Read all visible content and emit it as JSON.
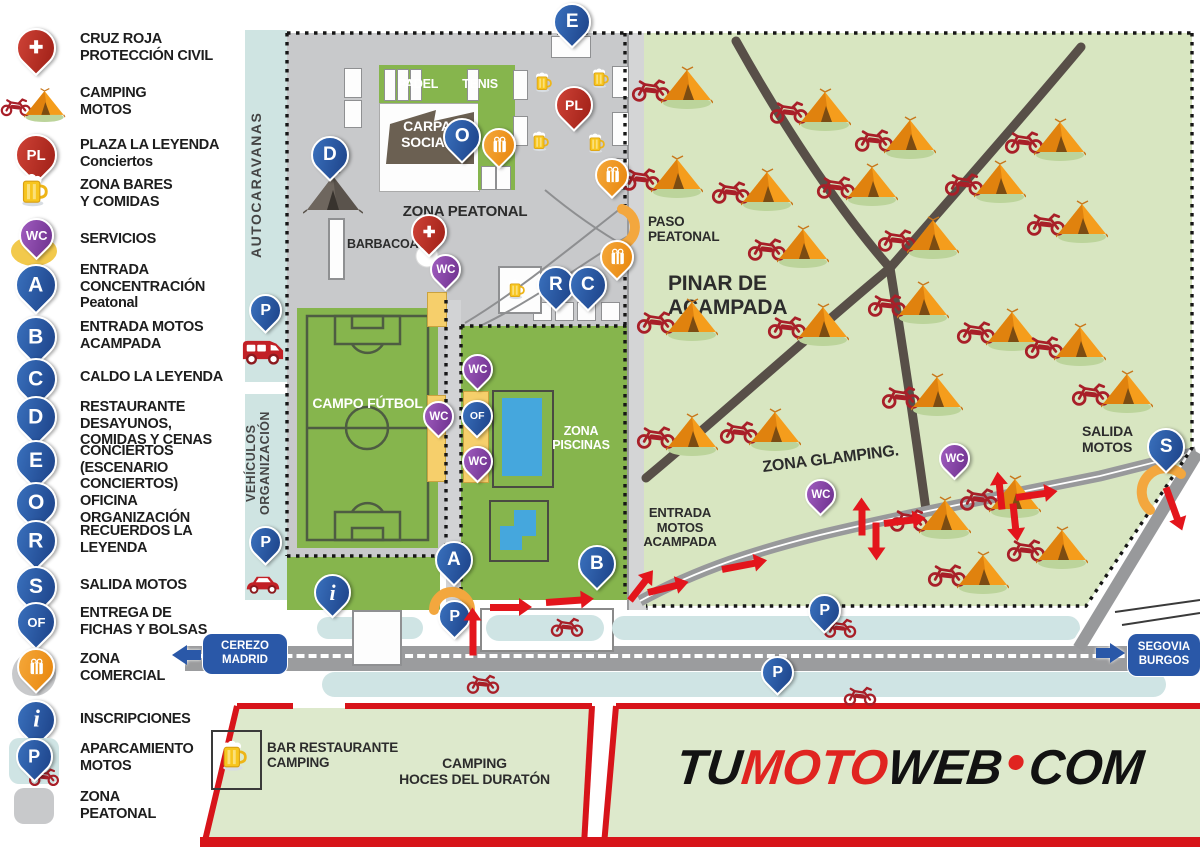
{
  "title": "Mapa concentración motera - plano del recinto",
  "colors": {
    "blue_pin": "#24549c",
    "red_pin": "#b92c21",
    "purple_pin": "#7c3f98",
    "orange": "#f29b1d",
    "camp_green": "#d8e6c1",
    "sport_green": "#86b54d",
    "gray_zone": "#c8c9cb",
    "road_gray": "#9b9c9e",
    "light_blue": "#cfe4e4",
    "service_yellow": "#f6cf6b",
    "red_accent": "#d7141a",
    "logo_red": "#e02420",
    "path_brown": "#584f48",
    "pool_blue": "#45a7dd"
  },
  "legend": {
    "items": [
      {
        "k": "cross",
        "label": "CRUZ ROJA\nPROTECCIÓN CIVIL",
        "y": 26,
        "name": "legend-cruz-roja"
      },
      {
        "k": "camp",
        "label": "CAMPING\nMOTOS",
        "y": 80,
        "name": "legend-camping-motos"
      },
      {
        "k": "pl",
        "t": "PL",
        "label": "PLAZA LA LEYENDA\nConciertos",
        "y": 132,
        "name": "legend-plaza-la-leyenda"
      },
      {
        "k": "mug",
        "label": "ZONA BARES\nY COMIDAS",
        "y": 172,
        "name": "legend-zona-bares"
      },
      {
        "k": "wcy",
        "t": "WC",
        "label": "SERVICIOS",
        "y": 218,
        "name": "legend-servicios"
      },
      {
        "k": "b",
        "t": "A",
        "label": "ENTRADA\nCONCENTRACIÓN\nPeatonal",
        "y": 262,
        "name": "legend-entrada-concentracion"
      },
      {
        "k": "b",
        "t": "B",
        "label": "ENTRADA MOTOS\nACAMPADA",
        "y": 314,
        "name": "legend-entrada-motos-acampada"
      },
      {
        "k": "b",
        "t": "C",
        "label": "CALDO LA LEYENDA",
        "y": 356,
        "name": "legend-caldo-la-leyenda"
      },
      {
        "k": "b",
        "t": "D",
        "label": "RESTAURANTE DESAYUNOS,\nCOMIDAS Y CENAS",
        "y": 394,
        "name": "legend-restaurante"
      },
      {
        "k": "b",
        "t": "E",
        "label": "CONCIERTOS\n(ESCENARIO CONCIERTOS)",
        "y": 438,
        "name": "legend-conciertos"
      },
      {
        "k": "b",
        "t": "O",
        "label": "OFICINA ORGANIZACIÓN",
        "y": 480,
        "name": "legend-oficina-organizacion"
      },
      {
        "k": "b",
        "t": "R",
        "label": "RECUERDOS LA\nLEYENDA",
        "y": 518,
        "name": "legend-recuerdos"
      },
      {
        "k": "b",
        "t": "S",
        "label": "SALIDA MOTOS",
        "y": 564,
        "name": "legend-salida-motos"
      },
      {
        "k": "of",
        "t": "OF",
        "label": "ENTREGA DE\nFICHAS Y BOLSAS",
        "y": 600,
        "name": "legend-entrega-fichas"
      },
      {
        "k": "bagc",
        "label": "ZONA\nCOMERCIAL",
        "y": 646,
        "name": "legend-zona-comercial"
      },
      {
        "k": "info",
        "t": "i",
        "label": "INSCRIPCIONES",
        "y": 698,
        "name": "legend-inscripciones"
      },
      {
        "k": "pmoto",
        "t": "P",
        "label": "APARCAMIENTO\nMOTOS",
        "y": 736,
        "name": "legend-aparcamiento-motos"
      },
      {
        "k": "gray",
        "label": "ZONA\nPEATONAL",
        "y": 784,
        "name": "legend-zona-peatonal"
      }
    ]
  },
  "map": {
    "labels": {
      "padel": "PADEL",
      "tenis": "TENIS",
      "carpa": "CARPA\nSOCIAL",
      "zonaPeatonal": "ZONA PEATONAL",
      "barbacoas": "BARBACOAS",
      "campo": "CAMPO FÚTBOL",
      "piscinas": "ZONA\nPISCINAS",
      "paso": "PASO\nPEATONAL",
      "pinar": "PINAR DE\nACAMPADA",
      "glamping": "ZONA GLAMPING.",
      "entrada": "ENTRADA\nMOTOS\nACAMPADA",
      "salida": "SALIDA\nMOTOS",
      "autocaravanas": "AUTOCARAVANAS",
      "vehiculos": "VEHÍCULOS\nORGANIZACIÓN",
      "barRest": "BAR RESTAURANTE\nCAMPING",
      "hoces": "CAMPING\nHOCES DEL DURATÓN"
    },
    "signs": {
      "west": "CEREZO\nMADRID",
      "east": "SEGOVIA\nBURGOS"
    },
    "logo": {
      "tu": "TU",
      "moto": "MOTO",
      "web": "WEB",
      "com": "COM"
    },
    "pins": [
      {
        "k": "b",
        "t": "E",
        "x": 570,
        "y": 3,
        "n": "map-pin-e-conciertos"
      },
      {
        "k": "b",
        "t": "O",
        "x": 460,
        "y": 118,
        "n": "map-pin-o-oficina"
      },
      {
        "k": "r",
        "t": "PL",
        "x": 572,
        "y": 86,
        "n": "map-pin-pl-plaza"
      },
      {
        "k": "b",
        "t": "D",
        "x": 328,
        "y": 136,
        "n": "map-pin-d-restaurante"
      },
      {
        "k": "b",
        "t": "R",
        "x": 554,
        "y": 266,
        "n": "map-pin-r-recuerdos"
      },
      {
        "k": "b",
        "t": "C",
        "x": 586,
        "y": 266,
        "n": "map-pin-c-caldo"
      },
      {
        "k": "b",
        "t": "A",
        "x": 452,
        "y": 541,
        "n": "map-pin-a-entrada"
      },
      {
        "k": "b",
        "t": "B",
        "x": 595,
        "y": 545,
        "n": "map-pin-b-entrada-motos"
      },
      {
        "k": "b",
        "t": "S",
        "x": 1164,
        "y": 428,
        "n": "map-pin-s-salida"
      },
      {
        "k": "info",
        "t": "i",
        "x": 330,
        "y": 574,
        "n": "map-pin-inscripciones"
      },
      {
        "k": "cross",
        "x": 427,
        "y": 214,
        "n": "map-pin-cruz-roja"
      },
      {
        "k": "p",
        "t": "P",
        "x": 263,
        "y": 294,
        "n": "map-pin-parking-autocaravanas"
      },
      {
        "k": "p",
        "t": "P",
        "x": 263,
        "y": 526,
        "n": "map-pin-parking-vehiculos"
      },
      {
        "k": "p",
        "t": "P",
        "x": 452,
        "y": 600,
        "n": "map-pin-parking-entrada"
      },
      {
        "k": "p",
        "t": "P",
        "x": 822,
        "y": 594,
        "n": "map-pin-parking-road-1"
      },
      {
        "k": "p",
        "t": "P",
        "x": 775,
        "y": 656,
        "n": "map-pin-parking-road-2"
      },
      {
        "k": "w",
        "t": "WC",
        "x": 443,
        "y": 254,
        "n": "map-pin-wc-1"
      },
      {
        "k": "w",
        "t": "WC",
        "x": 436,
        "y": 401,
        "n": "map-pin-wc-2"
      },
      {
        "k": "w",
        "t": "WC",
        "x": 475,
        "y": 354,
        "n": "map-pin-wc-3"
      },
      {
        "k": "of",
        "t": "OF",
        "x": 475,
        "y": 400,
        "n": "map-pin-of-fichas"
      },
      {
        "k": "w",
        "t": "WC",
        "x": 475,
        "y": 446,
        "n": "map-pin-wc-4"
      },
      {
        "k": "w",
        "t": "WC",
        "x": 818,
        "y": 479,
        "n": "map-pin-wc-5"
      },
      {
        "k": "w",
        "t": "WC",
        "x": 952,
        "y": 443,
        "n": "map-pin-wc-6"
      },
      {
        "k": "bag",
        "x": 497,
        "y": 128,
        "n": "map-pin-comercial-1"
      },
      {
        "k": "bag",
        "x": 610,
        "y": 158,
        "n": "map-pin-comercial-2"
      },
      {
        "k": "bag",
        "x": 615,
        "y": 240,
        "n": "map-pin-comercial-3"
      }
    ],
    "tents": [
      [
        687,
        88
      ],
      [
        825,
        110
      ],
      [
        910,
        138
      ],
      [
        1060,
        140
      ],
      [
        677,
        177
      ],
      [
        767,
        190
      ],
      [
        872,
        185
      ],
      [
        1000,
        182
      ],
      [
        1082,
        222
      ],
      [
        933,
        238
      ],
      [
        803,
        247
      ],
      [
        692,
        320
      ],
      [
        823,
        325
      ],
      [
        923,
        303
      ],
      [
        1012,
        330
      ],
      [
        1080,
        345
      ],
      [
        775,
        430
      ],
      [
        937,
        395
      ],
      [
        692,
        435
      ],
      [
        1015,
        497
      ],
      [
        945,
        518
      ],
      [
        1127,
        392
      ],
      [
        1062,
        548
      ],
      [
        983,
        573
      ]
    ],
    "mugs": [
      [
        543,
        83
      ],
      [
        600,
        79
      ],
      [
        540,
        142
      ],
      [
        596,
        144
      ],
      [
        516,
        290
      ]
    ],
    "road_motos": [
      [
        567,
        627
      ],
      [
        840,
        628
      ],
      [
        483,
        684
      ],
      [
        860,
        696
      ]
    ],
    "arrows": [
      [
        473,
        652,
        36,
        -90
      ],
      [
        490,
        604,
        30,
        0
      ],
      [
        546,
        599,
        36,
        -4
      ],
      [
        630,
        597,
        26,
        -52
      ],
      [
        648,
        589,
        30,
        -14
      ],
      [
        722,
        566,
        34,
        -11
      ],
      [
        862,
        532,
        26,
        -90
      ],
      [
        876,
        519,
        26,
        90
      ],
      [
        884,
        520,
        30,
        -7
      ],
      [
        1002,
        506,
        26,
        -96
      ],
      [
        1016,
        494,
        30,
        -8
      ],
      [
        1013,
        500,
        26,
        84
      ],
      [
        1166,
        484,
        34,
        70
      ]
    ]
  }
}
